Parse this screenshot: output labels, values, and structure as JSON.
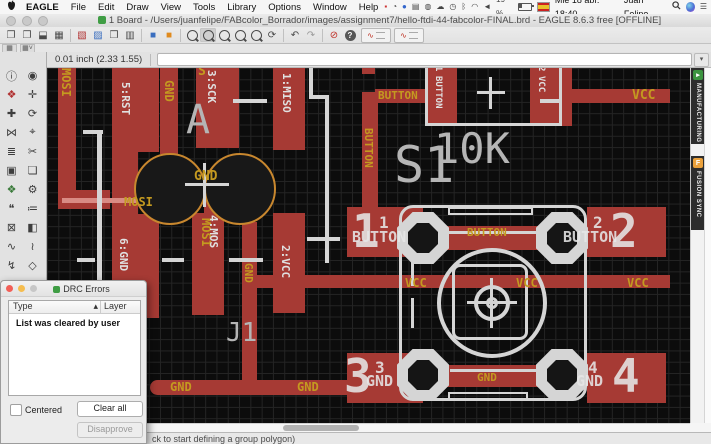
{
  "menu_bar": {
    "items": [
      "EAGLE",
      "File",
      "Edit",
      "Draw",
      "View",
      "Tools",
      "Library",
      "Options",
      "Window",
      "Help"
    ],
    "battery": "19 %",
    "date": "Mié 18 abr. 18:40",
    "user": "Juan Felipe"
  },
  "titlebar": {
    "title": "1 Board - /Users/juanfelipe/FABcolor_Borrador/images/assignment7/hello-ftdi-44-fabcolor-FINAL.brd - EAGLE 8.6.3 free [OFFLINE]"
  },
  "toolbar": {
    "buttons": [
      {
        "kind": "icon",
        "name": "new-window",
        "glyph": "❐"
      },
      {
        "kind": "icon",
        "name": "open-board",
        "glyph": "❐"
      },
      {
        "kind": "icon",
        "name": "save",
        "glyph": "⬓"
      },
      {
        "kind": "icon",
        "name": "print",
        "glyph": "▦"
      },
      {
        "kind": "sep"
      },
      {
        "kind": "icon",
        "name": "layer-settings",
        "glyph": "▧",
        "color": "#b03030"
      },
      {
        "kind": "icon",
        "name": "image-export",
        "glyph": "▨",
        "color": "#3a6ebf"
      },
      {
        "kind": "icon",
        "name": "cam-processor",
        "glyph": "❒"
      },
      {
        "kind": "icon",
        "name": "design-manager",
        "glyph": "▥"
      },
      {
        "kind": "sep"
      },
      {
        "kind": "icon",
        "name": "switch-to-schematic",
        "glyph": "■",
        "color": "#3a6ebf"
      },
      {
        "kind": "icon",
        "name": "switch-to-board",
        "glyph": "■",
        "color": "#e08a1e"
      },
      {
        "kind": "sep"
      },
      {
        "kind": "mag",
        "name": "zoom-fit"
      },
      {
        "kind": "mag",
        "name": "zoom-in",
        "selected": true
      },
      {
        "kind": "mag",
        "name": "zoom-out"
      },
      {
        "kind": "mag",
        "name": "zoom-select"
      },
      {
        "kind": "mag",
        "name": "zoom-previous"
      },
      {
        "kind": "icon",
        "name": "redraw",
        "glyph": "⟳"
      },
      {
        "kind": "sep"
      },
      {
        "kind": "icon",
        "name": "undo",
        "glyph": "↶"
      },
      {
        "kind": "icon",
        "name": "redo",
        "glyph": "↷",
        "color": "#9a9a9a"
      },
      {
        "kind": "sep"
      },
      {
        "kind": "icon",
        "name": "stop",
        "glyph": "⊘",
        "color": "#c03028"
      },
      {
        "kind": "help",
        "name": "help"
      },
      {
        "kind": "route",
        "name": "route-airwires"
      },
      {
        "kind": "route",
        "name": "quick-route"
      }
    ]
  },
  "command_bar": {
    "coordinates": "0.01 inch (2.33 1.55)",
    "command_value": "",
    "dropdown_glyph": "▾"
  },
  "sidebar": {
    "tools": [
      {
        "name": "info",
        "glyph": "ⓘ"
      },
      {
        "name": "show",
        "glyph": "◉"
      },
      {
        "name": "display-layers",
        "glyph": "❖",
        "color": "#b03030"
      },
      {
        "name": "mark",
        "glyph": "✛"
      },
      {
        "name": "move",
        "glyph": "✚"
      },
      {
        "name": "rotate",
        "glyph": "⟳"
      },
      {
        "name": "mirror",
        "glyph": "⋈"
      },
      {
        "name": "group",
        "glyph": "⌖"
      },
      {
        "name": "change",
        "glyph": "≣"
      },
      {
        "name": "cut",
        "glyph": "✂"
      },
      {
        "name": "delete",
        "glyph": "▣"
      },
      {
        "name": "copy",
        "glyph": "❏"
      },
      {
        "name": "add-part",
        "glyph": "❖",
        "color": "#3a7a3a"
      },
      {
        "name": "settings",
        "glyph": "⚙"
      },
      {
        "name": "name",
        "glyph": "❝"
      },
      {
        "name": "value",
        "glyph": "≔"
      },
      {
        "name": "lock",
        "glyph": "⊠"
      },
      {
        "name": "smash",
        "glyph": "◧"
      },
      {
        "name": "route",
        "glyph": "∿"
      },
      {
        "name": "ripup",
        "glyph": "≀"
      },
      {
        "name": "wire",
        "glyph": "↯"
      },
      {
        "name": "polygon",
        "glyph": "◇"
      }
    ]
  },
  "side_tabs": {
    "manufacturing": "MANUFACTURING",
    "fusion_sync": "FUSION SYNC",
    "manufacturing_color": "#3c9440",
    "fusion_color": "#eba13c",
    "fusion_icon_letter": "F"
  },
  "drc_dialog": {
    "title": "DRC Errors",
    "col_type": "Type",
    "sort_indicator": "▴",
    "col_layer": "Layer",
    "message": "List was cleared by user",
    "centered_label": "Centered",
    "clear_all_label": "Clear all",
    "disapprove_label": "Disapprove"
  },
  "status_bar": {
    "message": "ck to start defining a group polygon)"
  },
  "board": {
    "labels": [
      {
        "t": "MOSI",
        "x": 13,
        "y": 0,
        "k": "net",
        "o": "v",
        "s": 12
      },
      {
        "t": "GND",
        "x": 116,
        "y": 12,
        "k": "net",
        "o": "v",
        "s": 12
      },
      {
        "t": "S",
        "x": 151,
        "y": -3,
        "k": "net",
        "o": "h",
        "s": 13
      },
      {
        "t": "GND",
        "x": 147,
        "y": 102,
        "k": "net",
        "o": "h",
        "s": 13
      },
      {
        "t": "MOSI",
        "x": 77,
        "y": 128,
        "k": "net",
        "o": "h",
        "s": 12
      },
      {
        "t": "BUTTON",
        "x": 331,
        "y": 22,
        "k": "net",
        "o": "h",
        "s": 11
      },
      {
        "t": "BUTTON",
        "x": 316,
        "y": 60,
        "k": "net",
        "o": "v",
        "s": 11
      },
      {
        "t": "MOSI",
        "x": 153,
        "y": 150,
        "k": "net",
        "o": "v",
        "s": 12
      },
      {
        "t": "GND",
        "x": 196,
        "y": 195,
        "k": "net",
        "o": "v",
        "s": 11
      },
      {
        "t": "VCC",
        "x": 358,
        "y": 209,
        "k": "net",
        "o": "h",
        "s": 12
      },
      {
        "t": "VCC",
        "x": 469,
        "y": 209,
        "k": "net",
        "o": "h",
        "s": 12
      },
      {
        "t": "VCC",
        "x": 580,
        "y": 209,
        "k": "net",
        "o": "h",
        "s": 12
      },
      {
        "t": "VCC",
        "x": 585,
        "y": 21,
        "k": "net",
        "o": "h",
        "s": 13
      },
      {
        "t": "BUTTON",
        "x": 420,
        "y": 159,
        "k": "net",
        "o": "h",
        "s": 11
      },
      {
        "t": "GND",
        "x": 430,
        "y": 304,
        "k": "net",
        "o": "h",
        "s": 11
      },
      {
        "t": "GND",
        "x": 123,
        "y": 313,
        "k": "net",
        "o": "h",
        "s": 12
      },
      {
        "t": "GND",
        "x": 250,
        "y": 313,
        "k": "net",
        "o": "h",
        "s": 12
      },
      {
        "t": "5:RST",
        "x": 73,
        "y": 14,
        "k": "pad",
        "o": "v",
        "s": 11
      },
      {
        "t": "6:GND",
        "x": 71,
        "y": 170,
        "k": "pad",
        "o": "v",
        "s": 11
      },
      {
        "t": "3:SCK",
        "x": 159,
        "y": 2,
        "k": "pad",
        "o": "v",
        "s": 11
      },
      {
        "t": "1:MISO",
        "x": 234,
        "y": 5,
        "k": "pad",
        "o": "v",
        "s": 11
      },
      {
        "t": "4:MOS",
        "x": 161,
        "y": 147,
        "k": "pad",
        "o": "v",
        "s": 11
      },
      {
        "t": "2:VCC",
        "x": 233,
        "y": 177,
        "k": "pad",
        "o": "v",
        "s": 11
      },
      {
        "t": "1",
        "x": 386,
        "y": -2,
        "k": "pad",
        "o": "v",
        "s": 9
      },
      {
        "t": "BUTTON",
        "x": 386,
        "y": 8,
        "k": "pad",
        "o": "v",
        "s": 9
      },
      {
        "t": "2",
        "x": 489,
        "y": -2,
        "k": "pad",
        "o": "v",
        "s": 9
      },
      {
        "t": "VCC",
        "x": 489,
        "y": 8,
        "k": "pad",
        "o": "v",
        "s": 9
      },
      {
        "t": "A",
        "x": 139,
        "y": 32,
        "k": "ref",
        "o": "h",
        "s": 40
      },
      {
        "t": "S1",
        "x": 347,
        "y": 72,
        "k": "ref",
        "o": "h",
        "s": 50
      },
      {
        "t": "10K",
        "x": 387,
        "y": 60,
        "k": "ref",
        "o": "h",
        "s": 42
      },
      {
        "t": "J1",
        "x": 179,
        "y": 252,
        "k": "ref",
        "o": "h",
        "s": 26
      },
      {
        "t": "1",
        "x": 305,
        "y": 140,
        "k": "num",
        "o": "h",
        "s": 46
      },
      {
        "t": "1",
        "x": 332,
        "y": 147,
        "k": "num",
        "o": "h",
        "s": 16
      },
      {
        "t": "BUTTON",
        "x": 305,
        "y": 162,
        "k": "num",
        "o": "h",
        "s": 15
      },
      {
        "t": "2",
        "x": 563,
        "y": 140,
        "k": "num",
        "o": "h",
        "s": 46
      },
      {
        "t": "2",
        "x": 546,
        "y": 147,
        "k": "num",
        "o": "h",
        "s": 16
      },
      {
        "t": "BUTTON",
        "x": 516,
        "y": 162,
        "k": "num",
        "o": "h",
        "s": 15
      },
      {
        "t": "3",
        "x": 297,
        "y": 285,
        "k": "num",
        "o": "h",
        "s": 46
      },
      {
        "t": "3",
        "x": 328,
        "y": 292,
        "k": "num",
        "o": "h",
        "s": 16
      },
      {
        "t": "GND",
        "x": 319,
        "y": 306,
        "k": "num",
        "o": "h",
        "s": 15
      },
      {
        "t": "4",
        "x": 565,
        "y": 285,
        "k": "num",
        "o": "h",
        "s": 46
      },
      {
        "t": "4",
        "x": 541,
        "y": 292,
        "k": "num",
        "o": "h",
        "s": 16
      },
      {
        "t": "GND",
        "x": 529,
        "y": 306,
        "k": "num",
        "o": "h",
        "s": 15
      }
    ]
  },
  "colors": {
    "copper": "#a63a34",
    "net_label": "#c49a20",
    "silkscreen": "#d5d5d5",
    "drill_ring": "#c8872e"
  }
}
